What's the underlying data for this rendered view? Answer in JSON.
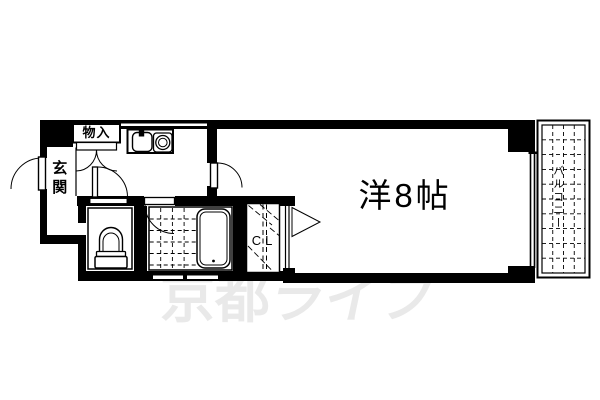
{
  "plan": {
    "type": "apartment-floor-plan",
    "rooms": {
      "main_room": {
        "label": "洋8帖"
      },
      "balcony": {
        "label": "バルコニー"
      },
      "entrance": {
        "label": "玄関"
      },
      "storage": {
        "label": "物入"
      },
      "closet": {
        "label": "CL"
      }
    },
    "colors": {
      "line": "#000000",
      "background": "#ffffff",
      "watermark": "#e9e9e9"
    }
  },
  "watermark": {
    "full": "京都ライフ",
    "part1": "京都",
    "part2": "ライフ"
  }
}
